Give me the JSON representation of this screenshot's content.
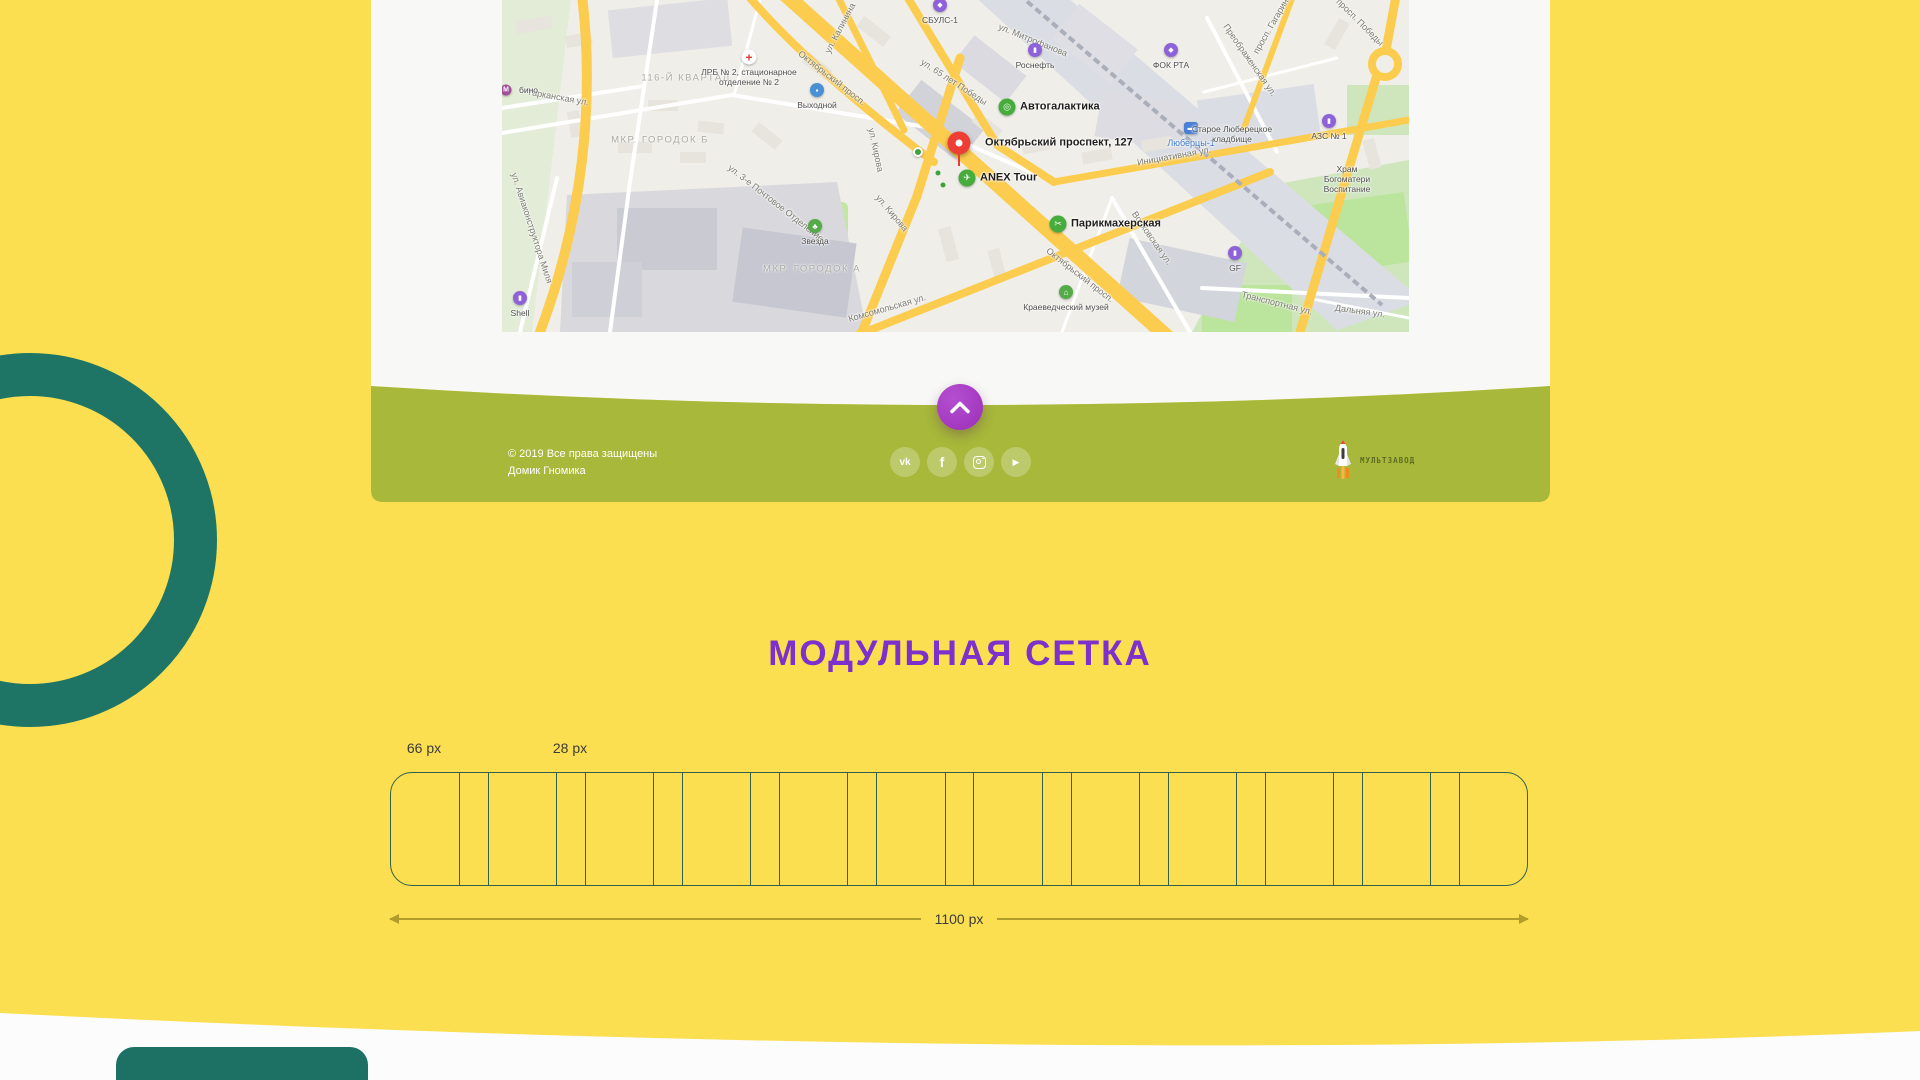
{
  "colors": {
    "page_bg": "#fbdf50",
    "panel_bg": "#f8f8f6",
    "footer_olive": "#a7b83a",
    "teal": "#1f7565",
    "button_purple": "#9c2eb9",
    "title_purple": "#7d30cb",
    "grid_line": "#33604a",
    "dimension_line": "#b29d2b"
  },
  "map": {
    "streets": [
      {
        "t": "Октябрьский просп.",
        "x": 330,
        "y": 78,
        "r": 38
      },
      {
        "t": "Октябрьский просп.",
        "x": 578,
        "y": 275,
        "r": 38
      },
      {
        "t": "ул. Калинина",
        "x": 338,
        "y": 28,
        "r": -62
      },
      {
        "t": "ул. Митрофанова",
        "x": 531,
        "y": 40,
        "r": 22
      },
      {
        "t": "ул. 65 лет Победы",
        "x": 452,
        "y": 82,
        "r": 33
      },
      {
        "t": "Инициативная ул.",
        "x": 672,
        "y": 156,
        "r": -10
      },
      {
        "t": "просп. Гагарина",
        "x": 770,
        "y": 24,
        "r": -60
      },
      {
        "t": "Преображенская ул.",
        "x": 748,
        "y": 60,
        "r": 55
      },
      {
        "t": "просп. Победы",
        "x": 858,
        "y": 22,
        "r": 45
      },
      {
        "t": "Комсомольская ул.",
        "x": 385,
        "y": 308,
        "r": -16
      },
      {
        "t": "ул. Кирова",
        "x": 390,
        "y": 213,
        "r": 50
      },
      {
        "t": "ул. Кирова",
        "x": 374,
        "y": 150,
        "r": 78
      },
      {
        "t": "Транспортная ул.",
        "x": 775,
        "y": 303,
        "r": 14
      },
      {
        "t": "Дальняя ул.",
        "x": 858,
        "y": 311,
        "r": 8
      },
      {
        "t": "Волковская ул.",
        "x": 650,
        "y": 238,
        "r": 55
      },
      {
        "t": "Тарканская ул.",
        "x": 56,
        "y": 97,
        "r": 10
      },
      {
        "t": "ул. Авиаконструктора Миля",
        "x": 30,
        "y": 228,
        "r": 72
      },
      {
        "t": "ул. 3-е Почтовое Отделение",
        "x": 274,
        "y": 203,
        "r": 38
      }
    ],
    "districts": [
      {
        "t": "116-Й КВАРТАЛ",
        "x": 184,
        "y": 78
      },
      {
        "t": "МКР. ГОРОДОК Б",
        "x": 158,
        "y": 140
      },
      {
        "t": "МКР. ГОРОДОК А",
        "x": 310,
        "y": 269
      }
    ],
    "pois": [
      {
        "t": "Октябрьский проспект, 127",
        "x": 457,
        "y": 143,
        "k": "pin",
        "side": "right",
        "lc": "b"
      },
      {
        "t": "Автогалактика",
        "x": 505,
        "y": 107,
        "k": "green",
        "g": "◎",
        "side": "right",
        "lc": "b"
      },
      {
        "t": "ANEX Tour",
        "x": 465,
        "y": 178,
        "k": "green",
        "g": "✈",
        "side": "right",
        "lc": "b"
      },
      {
        "t": "Парикмахерская",
        "x": 556,
        "y": 224,
        "k": "green",
        "g": "✂",
        "side": "right",
        "lc": "b"
      },
      {
        "t": "Звезда",
        "x": 313,
        "y": 226,
        "k": "green-sm",
        "g": "♣",
        "side": "below",
        "lc": "s"
      },
      {
        "t": "Краеведческий музей",
        "x": 564,
        "y": 292,
        "k": "green-sm",
        "g": "⌂",
        "side": "below",
        "lc": "s"
      },
      {
        "t": "Роснефть",
        "x": 533,
        "y": 50,
        "k": "purple",
        "g": "▮",
        "side": "below",
        "lc": "s"
      },
      {
        "t": "ФОК РТА",
        "x": 669,
        "y": 50,
        "k": "purple",
        "g": "◆",
        "side": "below",
        "lc": "s"
      },
      {
        "t": "СБУЛС-1",
        "x": 438,
        "y": 5,
        "k": "purple",
        "g": "◆",
        "side": "below",
        "lc": "s"
      },
      {
        "t": "АЗС № 1",
        "x": 827,
        "y": 121,
        "k": "purple",
        "g": "▮",
        "side": "below",
        "lc": "s"
      },
      {
        "t": "GF",
        "x": 733,
        "y": 253,
        "k": "purple",
        "g": "▮",
        "side": "below",
        "lc": "s"
      },
      {
        "t": "Shell",
        "x": 18,
        "y": 298,
        "k": "purple",
        "g": "▮",
        "side": "below",
        "lc": "s"
      },
      {
        "t": "Выходной",
        "x": 315,
        "y": 90,
        "k": "blue",
        "g": "▪",
        "side": "below",
        "lc": "s"
      },
      {
        "t": "Люберцы-1",
        "x": 689,
        "y": 128,
        "k": "station",
        "g": "▬",
        "side": "below",
        "lc": "blue"
      },
      {
        "t": "бино",
        "x": 4,
        "y": 90,
        "k": "metro",
        "g": "М",
        "side": "right",
        "lc": "s"
      },
      {
        "t": "ЛРБ № 2, стационарное\nотделение № 2",
        "x": 247,
        "y": 57,
        "k": "cross",
        "g": "+",
        "side": "below",
        "lc": "s"
      },
      {
        "t": "",
        "x": 416,
        "y": 152,
        "k": "dot"
      },
      {
        "t": "",
        "x": 436,
        "y": 173,
        "k": "minidot"
      },
      {
        "t": "",
        "x": 441,
        "y": 185,
        "k": "minidot"
      },
      {
        "t": "Старое Люберецкое\nкладбище",
        "x": 730,
        "y": 124,
        "k": "plain",
        "side": "below",
        "lc": "s"
      },
      {
        "t": "Храм Богоматери\nВоспитание",
        "x": 845,
        "y": 164,
        "k": "plain",
        "side": "below",
        "lc": "s"
      }
    ]
  },
  "footer": {
    "copyright_line1": "© 2019 Все права защищены",
    "copyright_line2": "Домик Гномика",
    "socials": [
      {
        "name": "vk",
        "glyph": "vk"
      },
      {
        "name": "facebook",
        "glyph": "f"
      },
      {
        "name": "instagram",
        "glyph": ""
      },
      {
        "name": "youtube",
        "glyph": "▶"
      }
    ],
    "logo_text": "МУЛЬТЗАВОД"
  },
  "scroll_top": {
    "label": "scroll to top"
  },
  "grid": {
    "title": "МОДУЛЬНАЯ СЕТКА",
    "col_label": "66 px",
    "gutter_label": "28 px",
    "width_label": "1100 px",
    "columns": 12,
    "column_px": 66,
    "gutter_px": 28,
    "total_px": 1100
  }
}
